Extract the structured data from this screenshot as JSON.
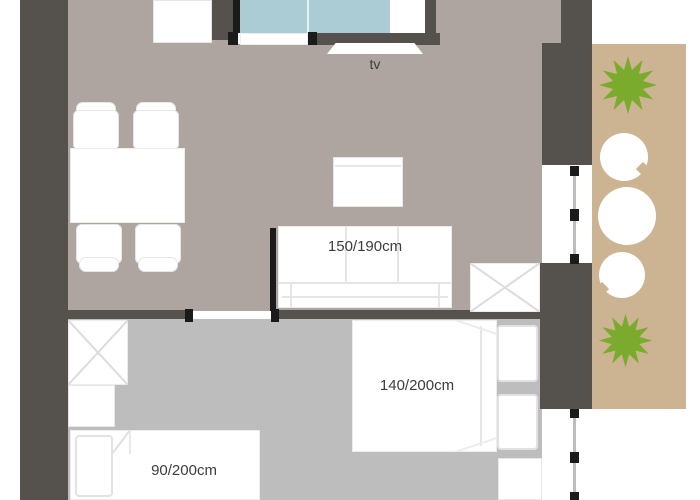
{
  "plan": {
    "tv_label": "tv",
    "sofa_size": "150/190cm",
    "double_bed_size": "140/200cm",
    "single_bed_size": "90/200cm"
  },
  "colors": {
    "wall": "#55524d",
    "frame-black": "#1b1b1b",
    "living-floor": "#aea5a1",
    "bedroom-floor": "#bdbdbd",
    "glass": "#abccd4",
    "balcony-floor": "#ccb492",
    "plant-green": "#7aab2d",
    "furniture-white": "#ffffff",
    "furniture-line": "#e6e6e6",
    "label-text": "#3d3d3d"
  }
}
